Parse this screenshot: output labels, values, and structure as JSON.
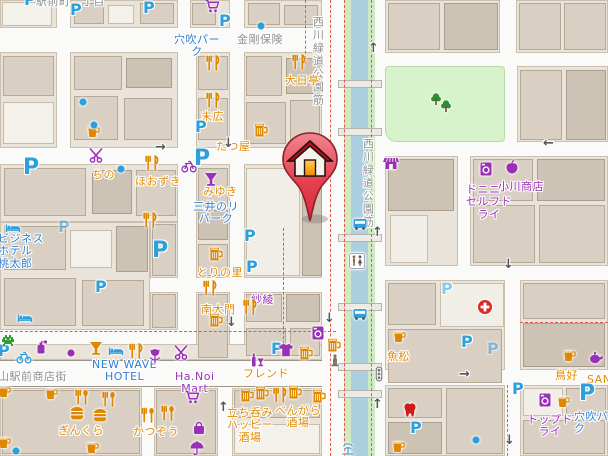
{
  "map": {
    "description": "street map with destination marker",
    "parking_glyph": "P",
    "colors": {
      "road": "#fafaf8",
      "block": "#eae3d9",
      "building": "#d9d0c3",
      "water": "#accfe0",
      "bank_green": "#cfeac2",
      "park_green": "#d7f3cc",
      "boundary_red": "#e4574d",
      "parking_blue": "#2da0dc",
      "poi_orange": "#dd8800",
      "poi_purple": "#9b30b8",
      "poi_green": "#2e9e2e",
      "label_gray": "#8f8f8f",
      "label_blue": "#2f7fd0",
      "label_orange": "#e08a00",
      "label_purple": "#9b30b8",
      "marker_red": "#dc2f44"
    },
    "labels": [
      {
        "text": "駅前町二丁目",
        "x": 36,
        "y": -4,
        "c": "gray"
      },
      {
        "text": "金剛保険",
        "x": 237,
        "y": 34,
        "c": "gray"
      },
      {
        "text": "西川緑道公園筋",
        "x": 311,
        "y": 16,
        "c": "gray",
        "v": true
      },
      {
        "text": "西川緑道公園筋",
        "x": 361,
        "y": 138,
        "c": "gray",
        "v": true
      },
      {
        "text": "山駅前商店街",
        "x": -2,
        "y": 371,
        "c": "gray"
      },
      {
        "text": "穴吹パー\nク",
        "x": 174,
        "y": 34,
        "c": "blue",
        "center": true
      },
      {
        "text": "三井のリ\nパーク",
        "x": 193,
        "y": 201,
        "c": "blue",
        "center": true
      },
      {
        "text": "ビジネス\nホテル\n桃太郎",
        "x": -2,
        "y": 233,
        "c": "blue"
      },
      {
        "text": "NEW WAVE\nHOTEL",
        "x": 92,
        "y": 359,
        "c": "blue",
        "center": true
      },
      {
        "text": "穴吹パー\nク",
        "x": 574,
        "y": 411,
        "c": "blue"
      },
      {
        "text": "大日亭",
        "x": 285,
        "y": 75,
        "c": "orange"
      },
      {
        "text": "末広",
        "x": 201,
        "y": 111,
        "c": "orange"
      },
      {
        "text": "たつ屋",
        "x": 216,
        "y": 141,
        "c": "orange"
      },
      {
        "text": "みゆき",
        "x": 203,
        "y": 186,
        "c": "orange"
      },
      {
        "text": "ちの",
        "x": 92,
        "y": 169,
        "c": "orange"
      },
      {
        "text": "ほおずき",
        "x": 135,
        "y": 176,
        "c": "orange"
      },
      {
        "text": "とりの里",
        "x": 197,
        "y": 267,
        "c": "orange"
      },
      {
        "text": "南大門",
        "x": 201,
        "y": 304,
        "c": "orange"
      },
      {
        "text": "紗綾",
        "x": 251,
        "y": 294,
        "c": "purple"
      },
      {
        "text": "フレンド",
        "x": 243,
        "y": 368,
        "c": "orange"
      },
      {
        "text": "Ha.Noi\nMart",
        "x": 175,
        "y": 371,
        "c": "purple",
        "center": true
      },
      {
        "text": "ぎんくら",
        "x": 58,
        "y": 425,
        "c": "orange"
      },
      {
        "text": "かつぞう",
        "x": 133,
        "y": 426,
        "c": "orange"
      },
      {
        "text": "立ち呑み\nハッピー\n酒場",
        "x": 227,
        "y": 407,
        "c": "orange",
        "center": true
      },
      {
        "text": "べんがら\n酒場",
        "x": 275,
        "y": 405,
        "c": "orange",
        "center": true
      },
      {
        "text": "魚松",
        "x": 387,
        "y": 351,
        "c": "orange"
      },
      {
        "text": "鳥好",
        "x": 555,
        "y": 370,
        "c": "orange"
      },
      {
        "text": "SAN",
        "x": 587,
        "y": 374,
        "c": "orange"
      },
      {
        "text": "トップド\nライ",
        "x": 527,
        "y": 414,
        "c": "purple",
        "center": true
      },
      {
        "text": "ドニニー\nセルフド\nライ",
        "x": 466,
        "y": 184,
        "c": "purple",
        "center": true
      },
      {
        "text": "小川商店",
        "x": 498,
        "y": 181,
        "c": "purple"
      }
    ],
    "pois": [
      {
        "icon": "parking",
        "x": 24,
        "y": -8
      },
      {
        "icon": "parking",
        "x": 70,
        "y": 2
      },
      {
        "icon": "parking",
        "x": 143,
        "y": 0
      },
      {
        "icon": "parking",
        "x": 219,
        "y": 13
      },
      {
        "icon": "parking",
        "x": 195,
        "y": 119
      },
      {
        "icon": "parking",
        "x": 194,
        "y": 148,
        "size": "big"
      },
      {
        "icon": "parking",
        "x": 244,
        "y": 228
      },
      {
        "icon": "parking",
        "x": 246,
        "y": 259
      },
      {
        "icon": "parking",
        "x": 23,
        "y": 157,
        "size": "big"
      },
      {
        "icon": "parking",
        "x": 58,
        "y": 219,
        "variant": "faint"
      },
      {
        "icon": "parking",
        "x": 152,
        "y": 240,
        "size": "big"
      },
      {
        "icon": "parking",
        "x": 95,
        "y": 279
      },
      {
        "icon": "parking",
        "x": 271,
        "y": 341
      },
      {
        "icon": "parking",
        "x": -2,
        "y": 343
      },
      {
        "icon": "parking",
        "x": 410,
        "y": 420
      },
      {
        "icon": "parking",
        "x": 461,
        "y": 334
      },
      {
        "icon": "parking",
        "x": 487,
        "y": 341,
        "variant": "faint"
      },
      {
        "icon": "parking",
        "x": 441,
        "y": 281,
        "variant": "light"
      },
      {
        "icon": "parking",
        "x": 512,
        "y": 381
      },
      {
        "icon": "parking",
        "x": 579,
        "y": 383,
        "size": "big"
      },
      {
        "icon": "fork-knife",
        "x": 205,
        "y": 55
      },
      {
        "icon": "fork-knife",
        "x": 205,
        "y": 92
      },
      {
        "icon": "fork-knife",
        "x": 291,
        "y": 54
      },
      {
        "icon": "fork-knife",
        "x": 144,
        "y": 155
      },
      {
        "icon": "fork-knife",
        "x": 142,
        "y": 212
      },
      {
        "icon": "fork-knife",
        "x": 202,
        "y": 280
      },
      {
        "icon": "fork-knife",
        "x": 242,
        "y": 299
      },
      {
        "icon": "fork-knife",
        "x": 272,
        "y": 387
      },
      {
        "icon": "fork-knife",
        "x": 128,
        "y": 343
      },
      {
        "icon": "fork-spoon",
        "x": 74,
        "y": 389
      },
      {
        "icon": "fork-spoon",
        "x": 101,
        "y": 391
      },
      {
        "icon": "fork-spoon",
        "x": 140,
        "y": 407
      },
      {
        "icon": "fork-spoon",
        "x": 160,
        "y": 405
      },
      {
        "icon": "beer",
        "x": 253,
        "y": 122
      },
      {
        "icon": "cup",
        "x": 85,
        "y": 123
      },
      {
        "icon": "beer",
        "x": 208,
        "y": 246
      },
      {
        "icon": "beer",
        "x": 208,
        "y": 312
      },
      {
        "icon": "beer",
        "x": 239,
        "y": 387
      },
      {
        "icon": "beer",
        "x": 254,
        "y": 385
      },
      {
        "icon": "beer",
        "x": 287,
        "y": 384
      },
      {
        "icon": "beer",
        "x": 311,
        "y": 388
      },
      {
        "icon": "beer",
        "x": 326,
        "y": 337
      },
      {
        "icon": "beer",
        "x": 298,
        "y": 345
      },
      {
        "icon": "cup",
        "x": 391,
        "y": 328
      },
      {
        "icon": "cup",
        "x": 561,
        "y": 347
      },
      {
        "icon": "cup",
        "x": 555,
        "y": 393
      },
      {
        "icon": "cup",
        "x": 390,
        "y": 438
      },
      {
        "icon": "cup",
        "x": 43,
        "y": 385
      },
      {
        "icon": "cup",
        "x": -4,
        "y": 383
      },
      {
        "icon": "cup",
        "x": 84,
        "y": 439
      },
      {
        "icon": "cup",
        "x": -4,
        "y": 434
      },
      {
        "icon": "burger",
        "x": 69,
        "y": 405
      },
      {
        "icon": "burger",
        "x": 92,
        "y": 407
      },
      {
        "icon": "cocktail",
        "x": 88,
        "y": 340,
        "variant": "orange"
      },
      {
        "icon": "cocktail",
        "x": 203,
        "y": 171,
        "variant": "purple"
      },
      {
        "icon": "bottle-glass",
        "x": 249,
        "y": 352
      },
      {
        "icon": "scissors",
        "x": 89,
        "y": 148
      },
      {
        "icon": "scissors",
        "x": 174,
        "y": 345
      },
      {
        "icon": "cart",
        "x": 204,
        "y": -2
      },
      {
        "icon": "cart",
        "x": 184,
        "y": 389
      },
      {
        "icon": "bicycle",
        "x": 181,
        "y": 158,
        "variant": "purple"
      },
      {
        "icon": "bicycle",
        "x": 16,
        "y": 349,
        "variant": "blue"
      },
      {
        "icon": "dot",
        "x": 75,
        "y": 94,
        "variant": "blue"
      },
      {
        "icon": "dot",
        "x": 86,
        "y": 117,
        "variant": "blue"
      },
      {
        "icon": "dot",
        "x": 253,
        "y": 18,
        "variant": "blue"
      },
      {
        "icon": "dot",
        "x": 113,
        "y": 161,
        "variant": "blue"
      },
      {
        "icon": "dot",
        "x": 63,
        "y": 345,
        "variant": "purple"
      },
      {
        "icon": "dot",
        "x": 8,
        "y": 443,
        "variant": "blue"
      },
      {
        "icon": "dot",
        "x": 468,
        "y": 432,
        "variant": "blue"
      },
      {
        "icon": "bed",
        "x": 5,
        "y": 219
      },
      {
        "icon": "bed",
        "x": 17,
        "y": 309
      },
      {
        "icon": "bed",
        "x": 108,
        "y": 342
      },
      {
        "icon": "tulip",
        "x": 147,
        "y": 348
      },
      {
        "icon": "tshirt",
        "x": 278,
        "y": 342
      },
      {
        "icon": "washer",
        "x": 310,
        "y": 325
      },
      {
        "icon": "washer",
        "x": 478,
        "y": 161
      },
      {
        "icon": "washer",
        "x": 537,
        "y": 392
      },
      {
        "icon": "tooth",
        "x": 402,
        "y": 402
      },
      {
        "icon": "red-cross",
        "x": 477,
        "y": 299
      },
      {
        "icon": "apple",
        "x": 504,
        "y": 159
      },
      {
        "icon": "teapot",
        "x": 588,
        "y": 349
      },
      {
        "icon": "perfume",
        "x": 33,
        "y": 339
      },
      {
        "icon": "invader",
        "x": 0,
        "y": 332
      },
      {
        "icon": "statue",
        "x": 327,
        "y": 352
      },
      {
        "icon": "toilet",
        "x": 349,
        "y": 253
      },
      {
        "icon": "bus",
        "x": 352,
        "y": 216
      },
      {
        "icon": "bus",
        "x": 352,
        "y": 306
      },
      {
        "icon": "traffic-light",
        "x": 371,
        "y": 366
      },
      {
        "icon": "shop",
        "x": 383,
        "y": 155
      },
      {
        "icon": "tree",
        "x": 428,
        "y": 91
      },
      {
        "icon": "tree",
        "x": 438,
        "y": 98
      },
      {
        "icon": "bag",
        "x": 191,
        "y": 420
      },
      {
        "icon": "umbrella",
        "x": 189,
        "y": 440
      },
      {
        "icon": "fountain",
        "x": 340,
        "y": 440
      }
    ],
    "arrows": [
      {
        "dir": "right",
        "x": 155,
        "y": 141
      },
      {
        "dir": "up",
        "x": 368,
        "y": 42
      },
      {
        "dir": "down",
        "x": 223,
        "y": 137
      },
      {
        "dir": "left",
        "x": 543,
        "y": 137
      },
      {
        "dir": "down",
        "x": 503,
        "y": 258
      },
      {
        "dir": "up",
        "x": 372,
        "y": 226
      },
      {
        "dir": "down",
        "x": 226,
        "y": 316
      },
      {
        "dir": "down",
        "x": 324,
        "y": 312
      },
      {
        "dir": "up",
        "x": 218,
        "y": 401
      },
      {
        "dir": "up",
        "x": 372,
        "y": 398
      },
      {
        "dir": "down",
        "x": 504,
        "y": 434
      },
      {
        "dir": "right",
        "x": 459,
        "y": 368
      }
    ],
    "marker": {
      "type": "destination-pin",
      "icon": "house"
    }
  }
}
